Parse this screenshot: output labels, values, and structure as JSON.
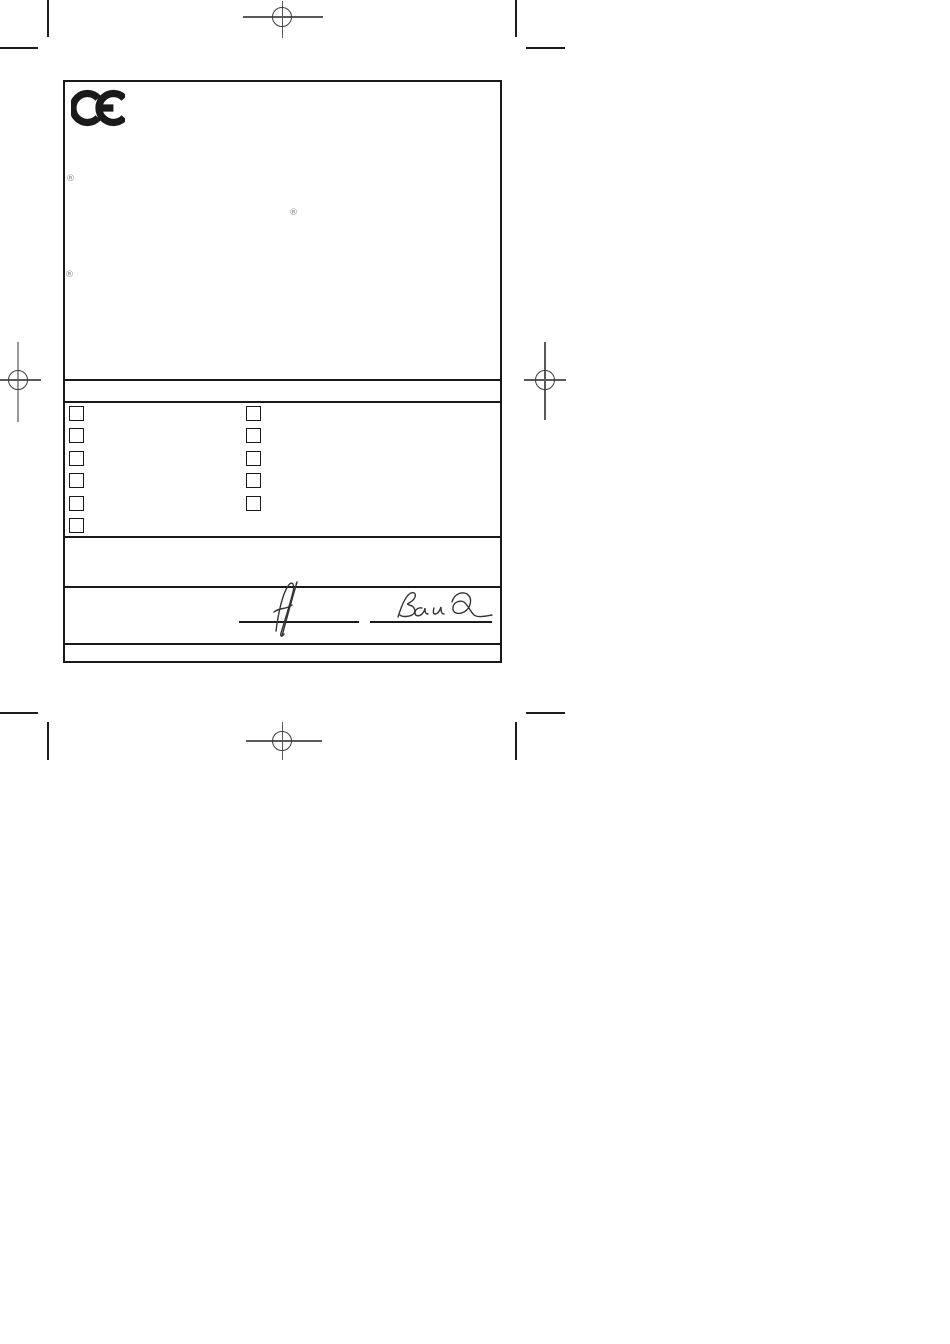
{
  "colors": {
    "paper": "#ffffff",
    "ink": "#1a1a1a",
    "registration_gray": "#5a5a5a",
    "symbol_gray": "#8a8a8a"
  },
  "ce_mark": {
    "label": "CE"
  },
  "symbols": {
    "registered_1": "®",
    "registered_2": "®",
    "registered_3": "®"
  },
  "checkboxes": {
    "left_column": [
      {
        "checked": false
      },
      {
        "checked": false
      },
      {
        "checked": false
      },
      {
        "checked": false
      },
      {
        "checked": false
      },
      {
        "checked": false
      }
    ],
    "right_column": [
      {
        "checked": false
      },
      {
        "checked": false
      },
      {
        "checked": false
      },
      {
        "checked": false
      },
      {
        "checked": false
      }
    ]
  },
  "signatures": {
    "left": {
      "icon": "handwritten-signature"
    },
    "right": {
      "icon": "handwritten-signature"
    }
  },
  "icons": {
    "ce_logo": "ce-marking",
    "registration_mark": "registration-crosshair",
    "crop_mark": "crop-mark"
  }
}
